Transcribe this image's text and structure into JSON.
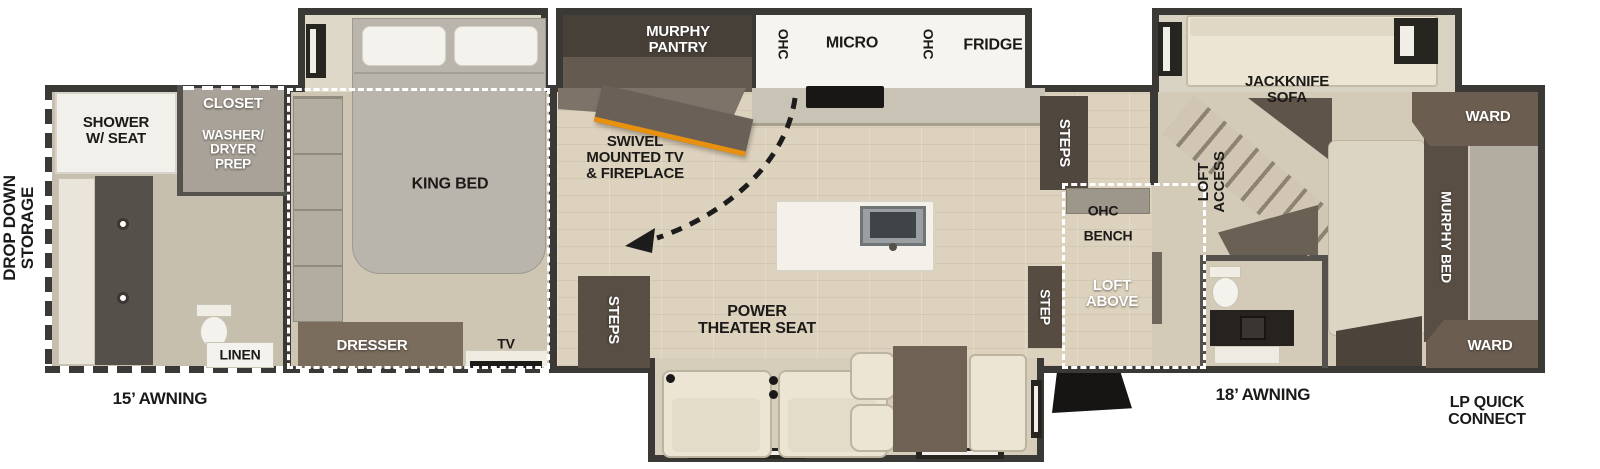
{
  "exterior": {
    "drop_down_storage": "DROP DOWN\nSTORAGE",
    "awning_left": "15’ AWNING",
    "awning_right": "18’ AWNING",
    "lp_quick_connect": "LP QUICK\nCONNECT"
  },
  "rear_bath": {
    "shower": "SHOWER\nW/ SEAT",
    "closet": "CLOSET",
    "washer_dryer": "WASHER/\nDRYER\nPREP",
    "linen": "LINEN"
  },
  "bedroom": {
    "king_bed": "KING BED",
    "dresser": "DRESSER",
    "tv": "TV"
  },
  "kitchen": {
    "murphy_pantry": "MURPHY\nPANTRY",
    "ohc_left": "OHC",
    "micro": "MICRO",
    "ohc_right": "OHC",
    "fridge": "FRIDGE",
    "swivel_tv": "SWIVEL\nMOUNTED TV\n& FIREPLACE"
  },
  "living": {
    "steps_left": "STEPS",
    "power_theater_seat": "POWER\nTHEATER SEAT",
    "steps_right": "STEPS",
    "step": "STEP"
  },
  "loft": {
    "ohc": "OHC",
    "bench": "BENCH",
    "loft_above": "LOFT\nABOVE",
    "loft_access": "LOFT\nACCESS"
  },
  "front_bedroom": {
    "jackknife_sofa": "JACKKNIFE\nSOFA",
    "ward_top": "WARD",
    "murphy_bed": "MURPHY BED",
    "ward_bottom": "WARD"
  },
  "colors": {
    "wall": "#3a3936",
    "floor": "#cec5b3",
    "wood_floor": "#dcd2bd",
    "slide_floor": "#ded8c8",
    "cabinet_brown": "#6b5d50",
    "steps_brown": "#584e44",
    "cream": "#ece5d4",
    "dark_counter": "#55504a",
    "fireplace_accent": "#e8910e",
    "dash_white": "#ffffff"
  }
}
